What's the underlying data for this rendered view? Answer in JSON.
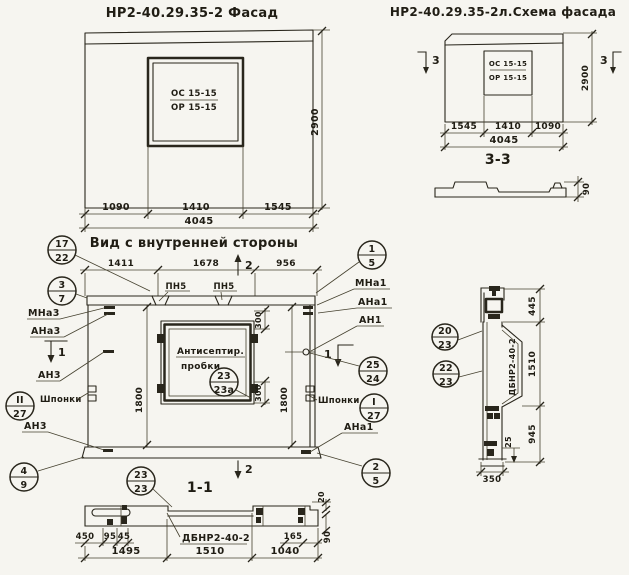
{
  "colors": {
    "paper": "#f6f5f0",
    "ink": "#29261c"
  },
  "facade": {
    "title": "НР2-40.29.35-2 Фасад",
    "window_top": "ОС 15-15",
    "window_bottom": "ОР 15-15",
    "dim_a": "1090",
    "dim_b": "1410",
    "dim_c": "1545",
    "dim_total": "4045",
    "dim_height": "2900"
  },
  "schema": {
    "title": "НР2-40.29.35-2л.Схема фасада",
    "window_top": "ОС 15-15",
    "window_bottom": "ОР 15-15",
    "dim_a": "1545",
    "dim_b": "1410",
    "dim_c": "1090",
    "dim_total": "4045",
    "dim_height": "2900",
    "marker_left": "3",
    "marker_right": "3",
    "section_title": "3-3",
    "section_thickness": "90"
  },
  "inner": {
    "title": "Вид с внутренней стороны",
    "dim_a": "1411",
    "dim_b": "1678",
    "dim_c": "956",
    "marker_top": "2",
    "marker_bottom": "2",
    "marker_left": "1",
    "marker_right": "1",
    "pn_left": "ПН5",
    "pn_right": "ПН5",
    "note_line1": "Антисептир.",
    "note_line2": "пробки",
    "dim_left": "1800",
    "dim_right": "1800",
    "dim_win_top": "300",
    "dim_win_bottom": "300",
    "lbl_mna3": "МНа3",
    "lbl_ana3": "АНа3",
    "lbl_an3": "АН3",
    "lbl_shponki_left": "Шпонки",
    "lbl_an3b": "АН3",
    "lbl_mna1": "МНа1",
    "lbl_ana1": "АНа1",
    "lbl_an1": "АН1",
    "lbl_shponki_right": "Шпонки",
    "lbl_ana1b": "АНа1"
  },
  "section11": {
    "title": "1-1",
    "beam_label": "ДБНР2-40-2",
    "dim_450": "450",
    "dim_95": "95",
    "dim_45": "45",
    "dim_1495": "1495",
    "dim_1510": "1510",
    "dim_1040": "1040",
    "dim_165": "165",
    "dim_90": "90",
    "dim_20": "20"
  },
  "side_section": {
    "beam_label": "ДБНР2-40-2",
    "dim_445": "445",
    "dim_1510": "1510",
    "dim_945": "945",
    "dim_350": "350",
    "dim_25": "25"
  },
  "callouts": {
    "c17_22": {
      "top": "17",
      "bottom": "22"
    },
    "c3_7": {
      "top": "3",
      "bottom": "7"
    },
    "c2_27": {
      "top": "II",
      "bottom": "27"
    },
    "c4_9": {
      "top": "4",
      "bottom": "9"
    },
    "c1_5": {
      "top": "1",
      "bottom": "5"
    },
    "c25_24": {
      "top": "25",
      "bottom": "24"
    },
    "c1_27": {
      "top": "I",
      "bottom": "27"
    },
    "c2_5": {
      "top": "2",
      "bottom": "5"
    },
    "c23_23a": {
      "top": "23",
      "bottom": "23а"
    },
    "c23_23": {
      "top": "23",
      "bottom": "23"
    },
    "c20_23": {
      "top": "20",
      "bottom": "23"
    },
    "c22_23": {
      "top": "22",
      "bottom": "23"
    }
  }
}
